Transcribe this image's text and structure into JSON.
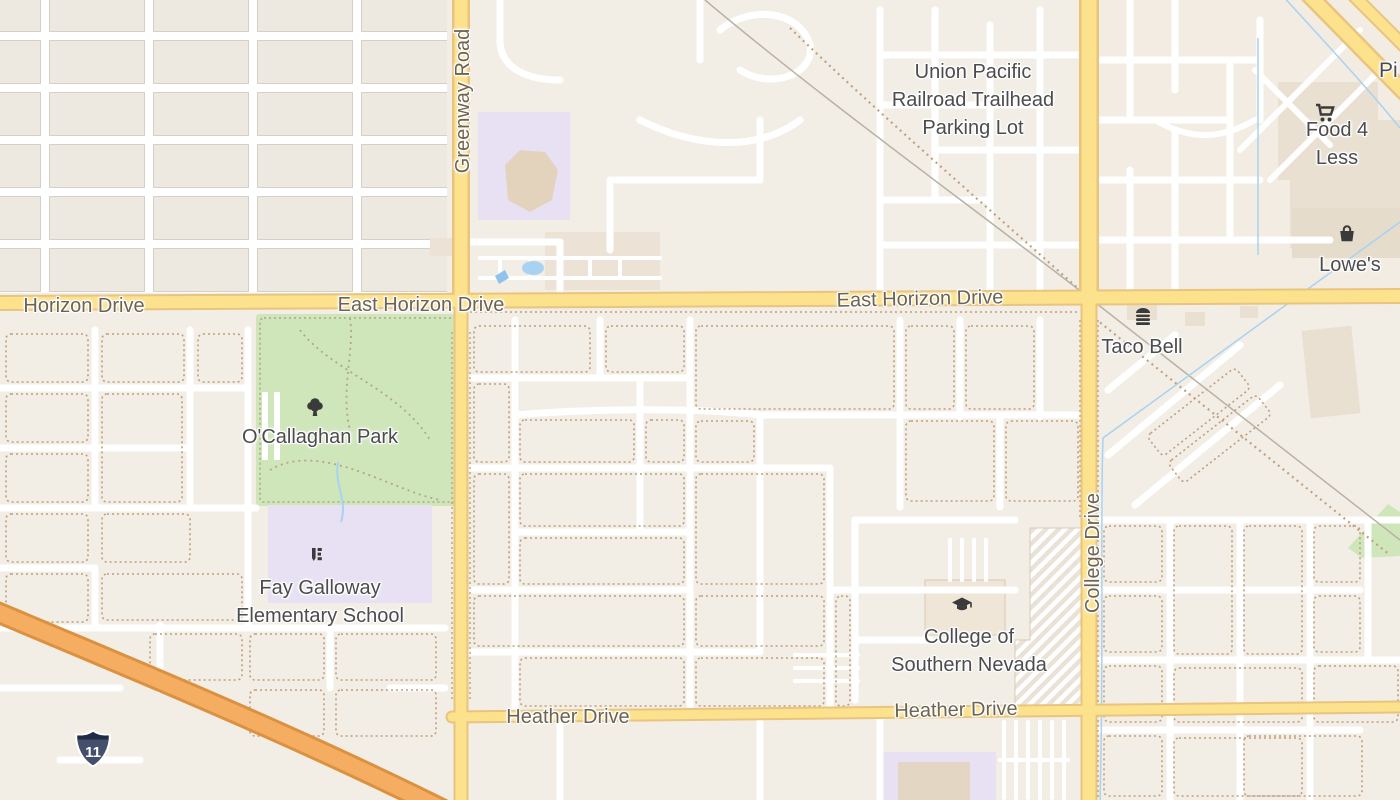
{
  "map_labels": {
    "union_pacific": "Union Pacific\nRailroad Trailhead\nParking Lot",
    "food_4_less": "Food 4 Less",
    "lowes": "Lowe's",
    "taco_bell": "Taco Bell",
    "ocallaghan_park": "O'Callaghan Park",
    "fay_galloway": "Fay Galloway\nElementary School",
    "csn": "College of\nSouthern Nevada",
    "partial_poi": "Pi"
  },
  "road_labels": {
    "horizon_west": "Horizon Drive",
    "east_horizon_1": "East Horizon Drive",
    "east_horizon_2": "East Horizon Drive",
    "greenway": "Greenway Road",
    "college": "College Drive",
    "heather_1": "Heather Drive",
    "heather_2": "Heather Drive"
  },
  "shields": {
    "interstate_11": "11"
  },
  "icons": {
    "food_4_less": "shopping-cart-icon",
    "lowes": "shopping-basket-icon",
    "taco_bell": "burger-icon",
    "ocallaghan_park": "tree-icon",
    "fay_galloway": "school-icon",
    "csn": "graduation-cap-icon"
  },
  "colors": {
    "base": "#f2eee6",
    "major_road_fill": "#fce28d",
    "major_road_casing": "#e9c47e",
    "highway_fill": "#f5ad62",
    "highway_casing": "#db913f",
    "park_green": "#cfe6bb",
    "school_purple": "#e8e1f3",
    "water_blue": "#a8d2f2",
    "building_tan": "#e9e0d2",
    "poi_text": "#4c4c4e",
    "road_text": "#6d6352",
    "block_outline": "#c19e7b",
    "shield_blue": "#44506b"
  }
}
